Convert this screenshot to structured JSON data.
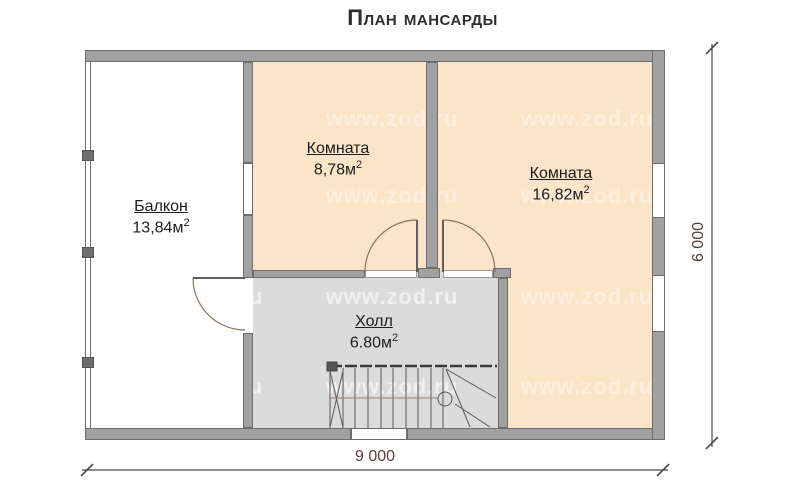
{
  "title": "План мансарды",
  "watermark": {
    "text": "www.zod.ru"
  },
  "rooms": [
    {
      "label": "Балкон",
      "area": "13,84м",
      "sup": "2"
    },
    {
      "label": "Комната",
      "area": "8,78м",
      "sup": "2"
    },
    {
      "label": "Комната",
      "area": "16,82м",
      "sup": "2"
    },
    {
      "label": "Холл",
      "area": "6.80м",
      "sup": "2"
    }
  ],
  "dimensions": {
    "width": "9 000",
    "height": "6 000"
  },
  "colors": {
    "room_fill": "#fce4c8",
    "hall_fill": "#dbdbdb",
    "wall_fill": "#a1a1a1",
    "wall_edge": "#6d6d6d",
    "dimension_text": "#5a3d3d",
    "watermark": "#ffffff"
  }
}
